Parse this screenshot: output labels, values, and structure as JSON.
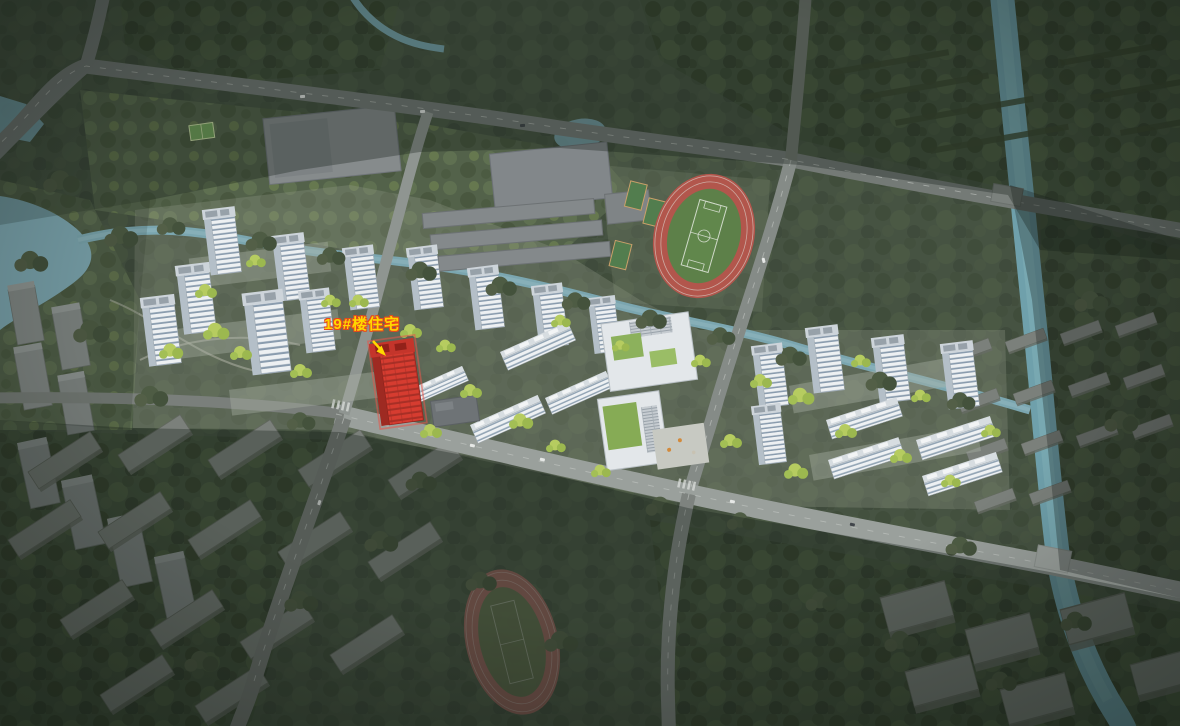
{
  "scene": {
    "description": "aerial-architectural-rendering-of-residential-masterplan",
    "annotation": {
      "label": "19#楼住宅",
      "target": "building-19-highlighted-red"
    },
    "colors": {
      "highlight_building": "#d63c30",
      "label_text": "#ffd800",
      "label_outline": "#e8491d",
      "river": "#74a3ad",
      "track_red": "#b2564c",
      "pitch_green": "#5d8049",
      "dev_tree": "#b6cc60",
      "forest": "#42503c",
      "road": "#9aa09c"
    }
  }
}
